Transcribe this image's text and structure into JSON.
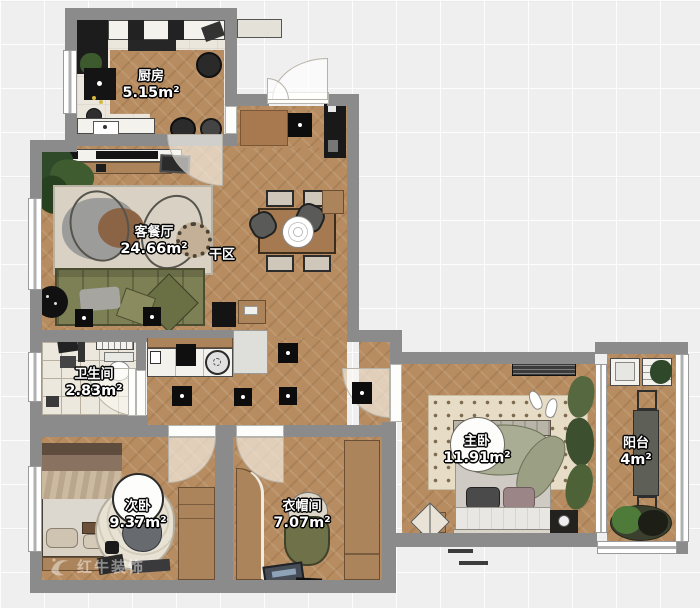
{
  "rooms": [
    {
      "name": "厨房",
      "area": "5.15m²"
    },
    {
      "name": "客餐厅",
      "area": "24.66m²"
    },
    {
      "name": "干区",
      "area": ""
    },
    {
      "name": "卫生间",
      "area": "2.83m²"
    },
    {
      "name": "次卧",
      "area": "9.37m²"
    },
    {
      "name": "衣帽间",
      "area": "7.07m²"
    },
    {
      "name": "主卧",
      "area": "11.91m²"
    },
    {
      "name": "阳台",
      "area": "4m²"
    }
  ],
  "watermark": {
    "brand": "红牛装饰"
  },
  "colors": {
    "background": "#efefef",
    "wall": "#8b8b8b",
    "wood_floor": "#b78c60",
    "tile_floor": "#ece8de",
    "kitchen_floor": "#ebe7dd",
    "sofa_green": "#7e8056",
    "label_text": "#ffffff",
    "label_outline": "#000000"
  }
}
